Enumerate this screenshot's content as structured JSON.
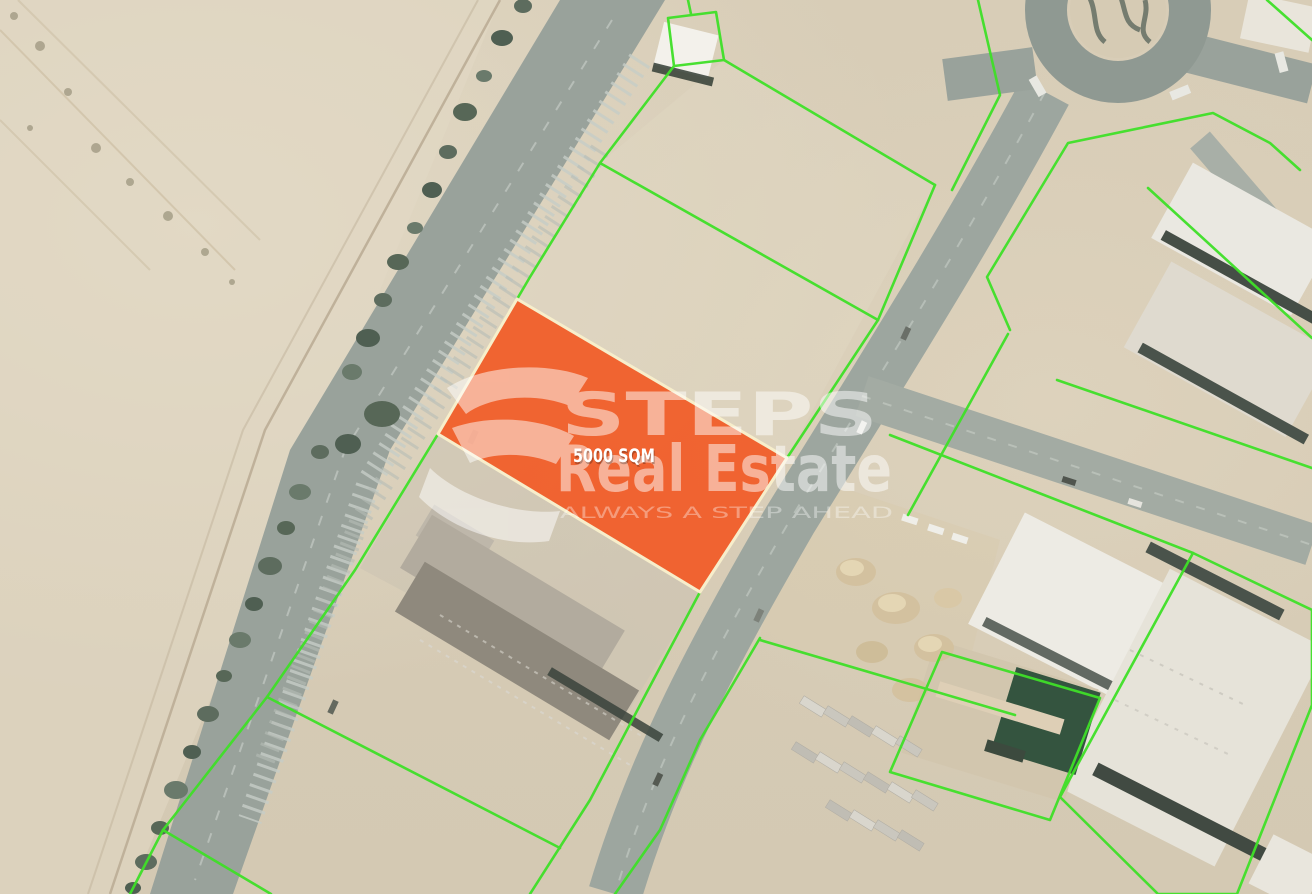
{
  "map": {
    "highlighted_plot": {
      "area_label": "5000 SQM",
      "fill_color": "#f15c28",
      "border_color": "#f7eecb"
    },
    "watermark": {
      "brand_line1": "STEPS",
      "brand_line2": "Real Estate",
      "tagline": "ALWAYS A STEP AHEAD",
      "color": "#ffffff"
    },
    "colors": {
      "parcel_boundary_green": "#3fe028",
      "road_gray": "#9aa29a",
      "sand": "#d8cdb7",
      "tree_green": "#5d6c5e"
    },
    "features": {
      "roundabout": "roundabout",
      "highway": "tree-lined-highway",
      "warehouses": "industrial-warehouses",
      "truck_yard": "truck-yard"
    }
  }
}
